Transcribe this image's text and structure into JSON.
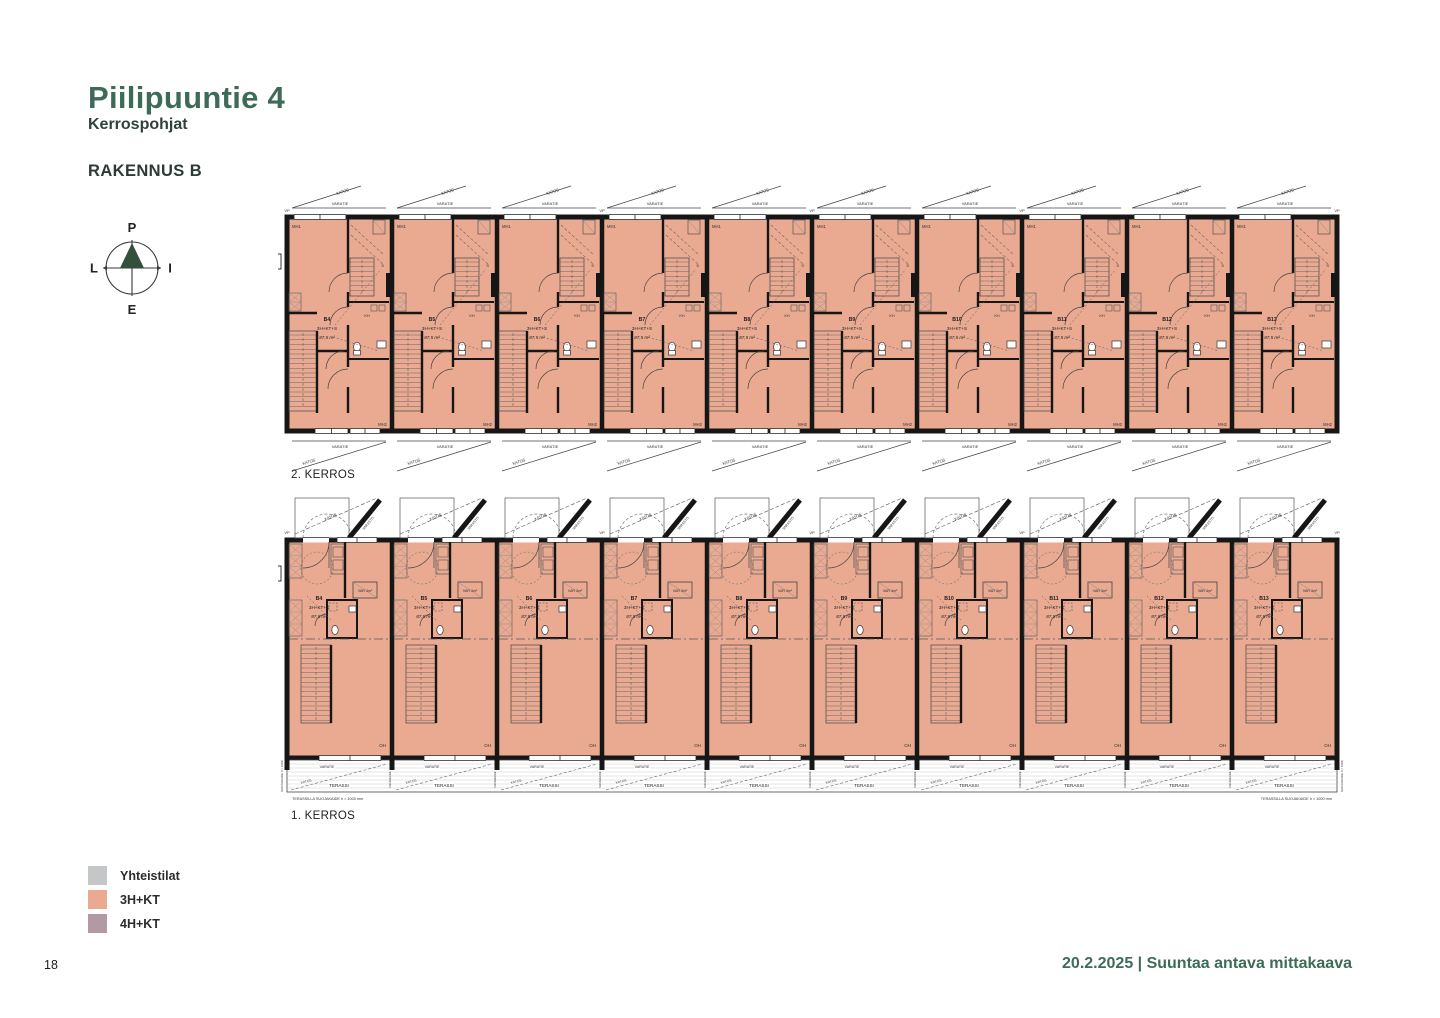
{
  "page": {
    "title": "Piilipuuntie 4",
    "subtitle": "Kerrospohjat",
    "building": "RAKENNUS B",
    "page_number": "18",
    "footer": "20.2.2025 | Suuntaa antava mittakaava"
  },
  "compass": {
    "north": "P",
    "east": "I",
    "south": "E",
    "west": "L"
  },
  "colors": {
    "accent_green": "#3E6B58",
    "compass_green": "#33503F",
    "wall": "#161616",
    "apartment_fill": "#EAAA91",
    "legend_gray": "#C5C6C8",
    "legend_salmon": "#EAAA91",
    "legend_mauve": "#B19AA3"
  },
  "plans": [
    {
      "name": "2. KERROS",
      "units": [
        {
          "id": "B4",
          "type": "3H+KT+S",
          "area": "87,5 m²"
        },
        {
          "id": "B5",
          "type": "3H+KT+S",
          "area": "87,5 m²"
        },
        {
          "id": "B6",
          "type": "3H+KT+S",
          "area": "87,5 m²"
        },
        {
          "id": "B7",
          "type": "3H+KT+S",
          "area": "87,5 m²"
        },
        {
          "id": "B8",
          "type": "3H+KT+S",
          "area": "87,5 m²"
        },
        {
          "id": "B9",
          "type": "3H+KT+S",
          "area": "87,5 m²"
        },
        {
          "id": "B10",
          "type": "3H+KT+S",
          "area": "87,5 m²"
        },
        {
          "id": "B11",
          "type": "3H+KT+S",
          "area": "87,5 m²"
        },
        {
          "id": "B12",
          "type": "3H+KT+S",
          "area": "87,5 m²"
        },
        {
          "id": "B13",
          "type": "3H+KT+S",
          "area": "87,5 m²"
        }
      ]
    },
    {
      "name": "1. KERROS",
      "units": [
        {
          "id": "B4",
          "type": "3H+KT+S",
          "area": "87,5 m²"
        },
        {
          "id": "B5",
          "type": "3H+KT+S",
          "area": "87,5 m²"
        },
        {
          "id": "B6",
          "type": "3H+KT+S",
          "area": "87,5 m²"
        },
        {
          "id": "B7",
          "type": "3H+KT+S",
          "area": "87,5 m²"
        },
        {
          "id": "B8",
          "type": "3H+KT+S",
          "area": "87,5 m²"
        },
        {
          "id": "B9",
          "type": "3H+KT+S",
          "area": "87,5 m²"
        },
        {
          "id": "B10",
          "type": "3H+KT+S",
          "area": "87,5 m²"
        },
        {
          "id": "B11",
          "type": "3H+KT+S",
          "area": "87,5 m²"
        },
        {
          "id": "B12",
          "type": "3H+KT+S",
          "area": "87,5 m²"
        },
        {
          "id": "B13",
          "type": "3H+KT+S",
          "area": "87,5 m²"
        }
      ]
    }
  ],
  "plan_labels": {
    "varatie": "VARATIE",
    "katos": "KATOS",
    "terassi": "TERASSI",
    "varasto": "VARASTO",
    "vp": "VP",
    "mh1": "MH1",
    "mh2": "MH2",
    "kh": "KH",
    "sauna": "S",
    "oh": "OH",
    "var_closet": "VAR 3m²",
    "tikkaat_line1": "TIKKAAT",
    "tikkaat_line2": "VESIKATOLLE",
    "terrace_note": "TERASSILLA SUOJAKAIDE h = 1000 mm",
    "guard": "SUOJAKAIDE",
    "guard_side": "SUOJAKAIDE h = 1000"
  },
  "legend": {
    "items": [
      {
        "label": "Yhteistilat",
        "color": "#C5C6C8"
      },
      {
        "label": "3H+KT",
        "color": "#EAAA91"
      },
      {
        "label": "4H+KT",
        "color": "#B19AA3"
      }
    ]
  }
}
